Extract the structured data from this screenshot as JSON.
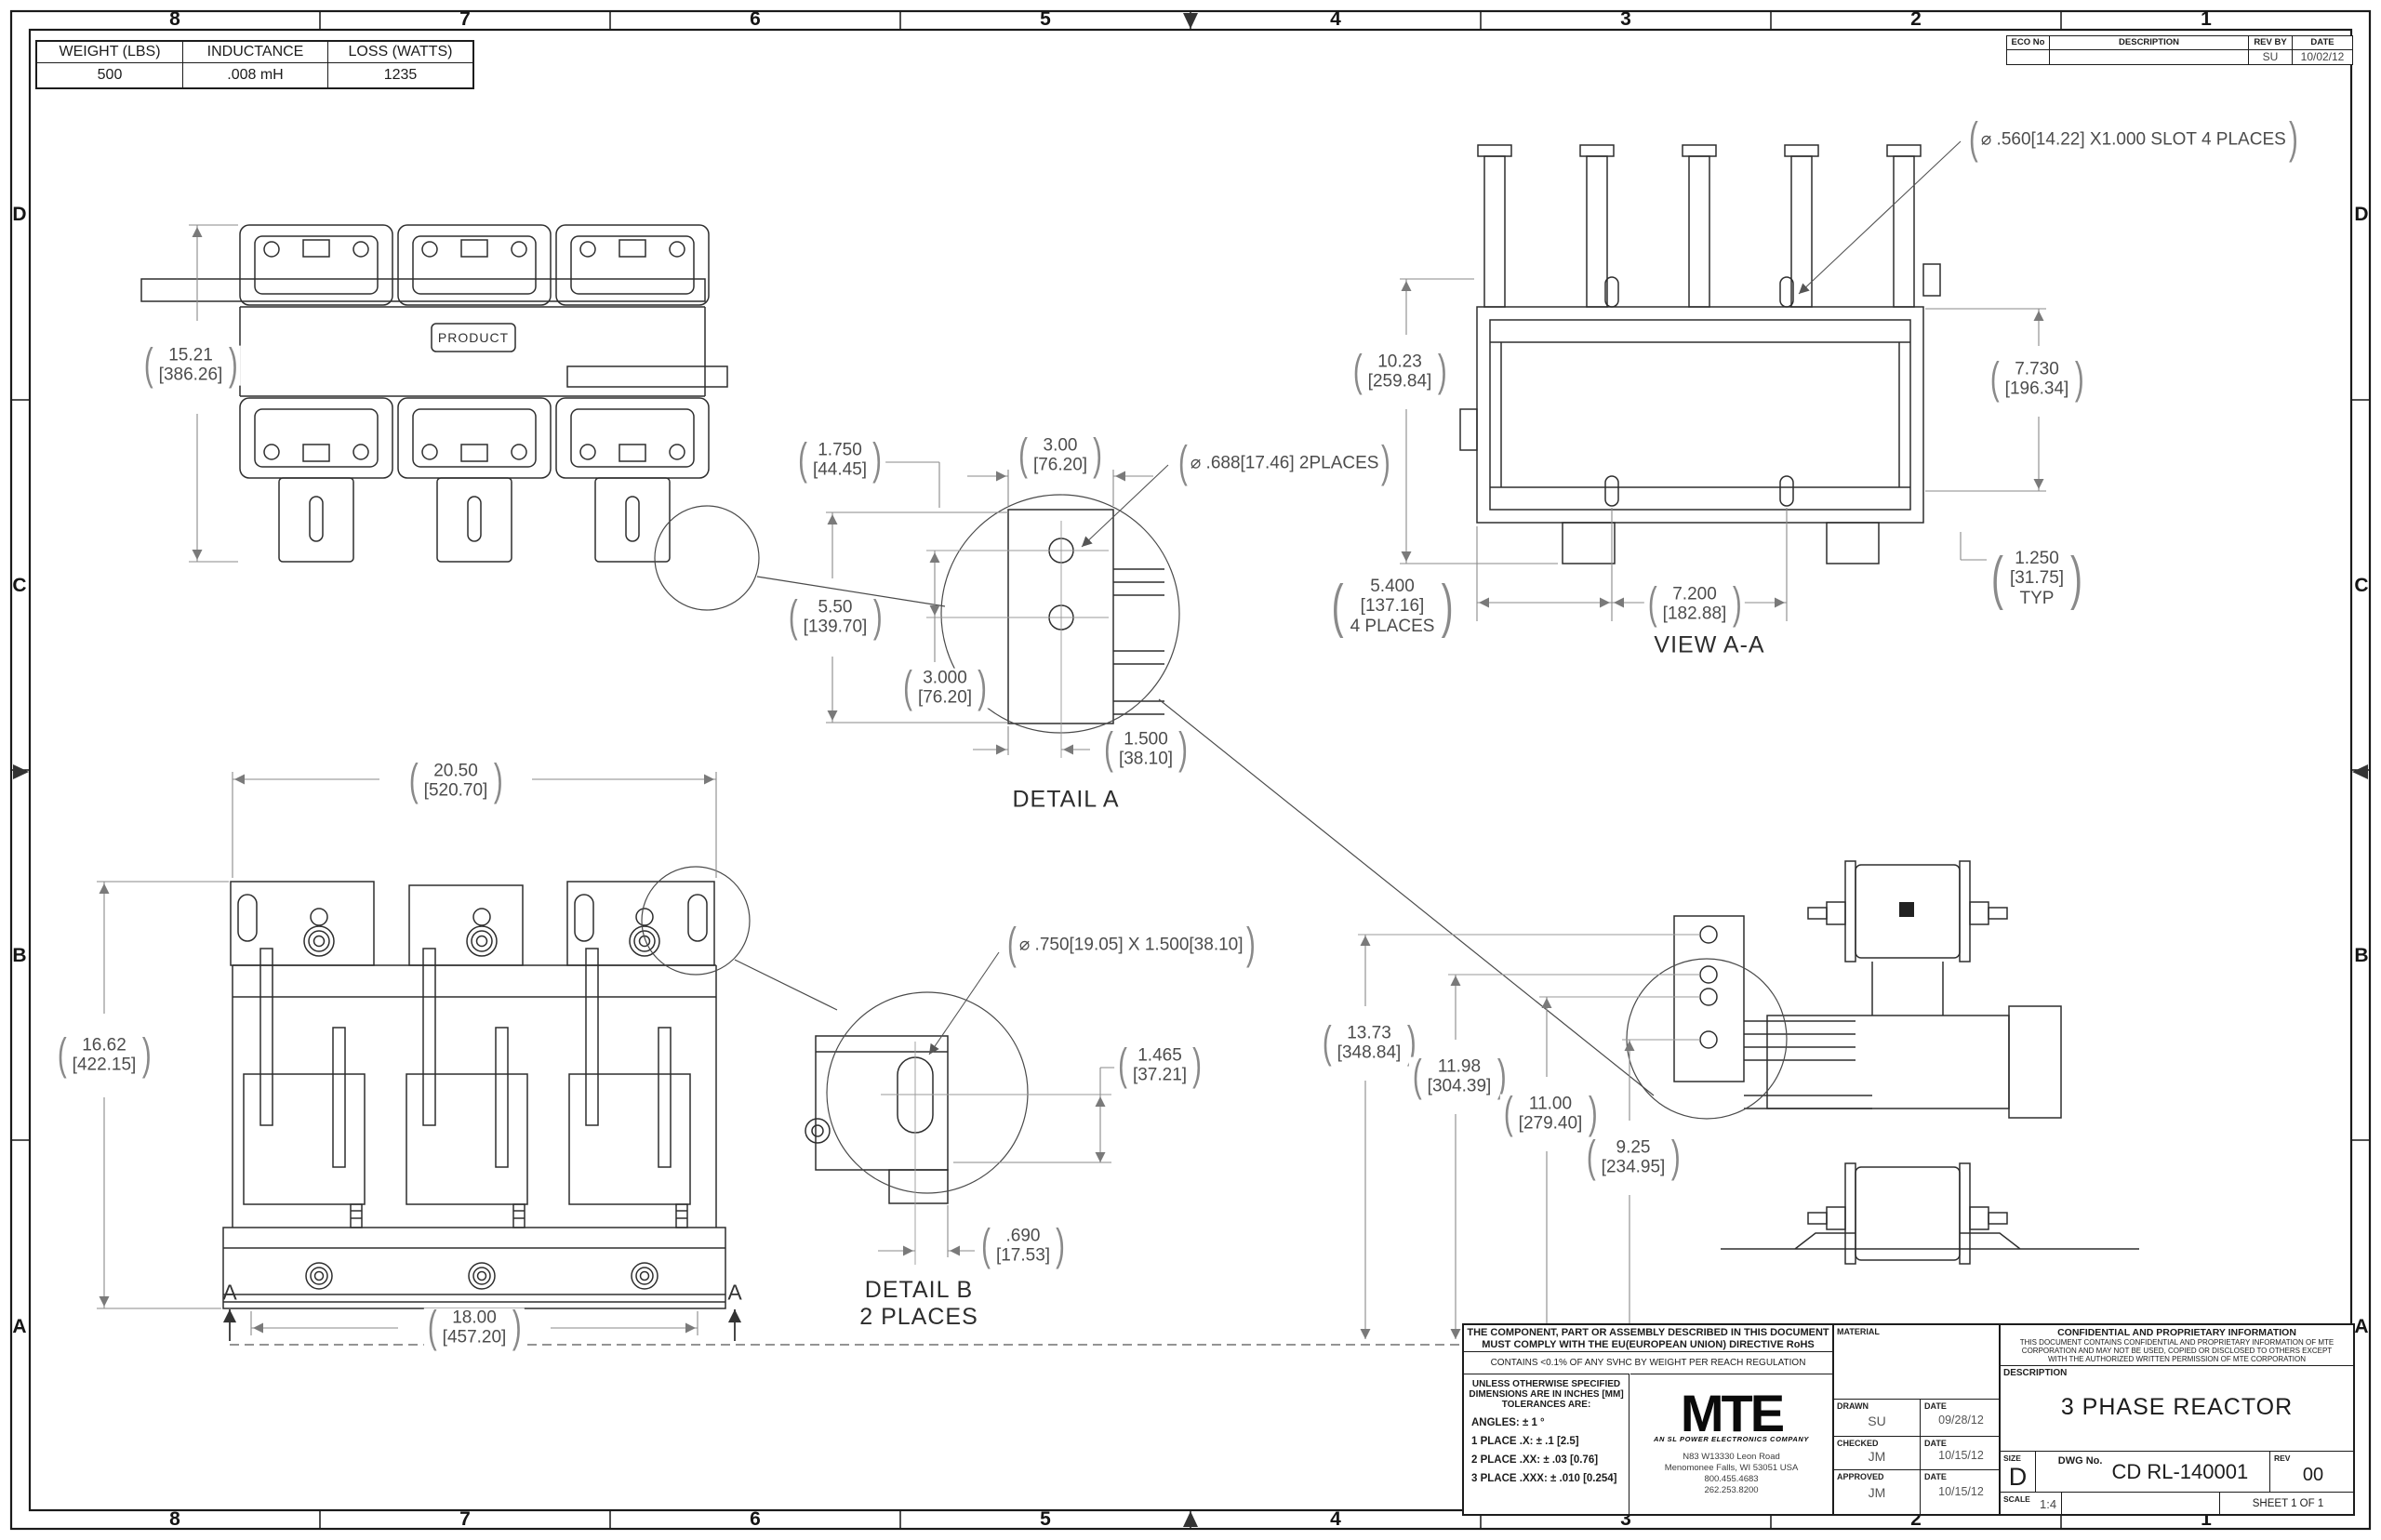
{
  "punct": {
    "lp": "(",
    "rp": ")"
  },
  "zones": {
    "cols": [
      "8",
      "7",
      "6",
      "5",
      "4",
      "3",
      "2",
      "1"
    ],
    "rows": [
      "D",
      "C",
      "B",
      "A"
    ]
  },
  "spec_table": {
    "headers": [
      "WEIGHT (LBS)",
      "INDUCTANCE",
      "LOSS (WATTS)"
    ],
    "values": [
      "500",
      ".008 mH",
      "1235"
    ]
  },
  "eco_table": {
    "headers": [
      "ECO No",
      "DESCRIPTION",
      "REV BY",
      "DATE"
    ],
    "row": {
      "eco_no": "",
      "description": "",
      "rev_by": "SU",
      "date": "10/02/12"
    }
  },
  "views": {
    "top": {
      "product": "PRODUCT",
      "height": {
        "in": "15.21",
        "mm": "[386.26]"
      }
    },
    "aa": {
      "label": "VIEW A-A",
      "slot_callout": "⌀ .560[14.22] X1.000 SLOT 4 PLACES",
      "height": {
        "in": "10.23",
        "mm": "[259.84]"
      },
      "width": {
        "in": "7.730",
        "mm": "[196.34]"
      },
      "spacing": {
        "in": "5.400",
        "mm": "[137.16]",
        "note": "4 PLACES"
      },
      "pitch": {
        "in": "7.200",
        "mm": "[182.88]"
      },
      "edge": {
        "in": "1.250",
        "mm": "[31.75]",
        "note": "TYP"
      }
    },
    "detail_a": {
      "label": "DETAIL A",
      "hole_callout": "⌀ .688[17.46]  2PLACES",
      "width_top": {
        "in": "3.00",
        "mm": "[76.20]"
      },
      "offset_top": {
        "in": "1.750",
        "mm": "[44.45]"
      },
      "height": {
        "in": "5.50",
        "mm": "[139.70]"
      },
      "pitch": {
        "in": "3.000",
        "mm": "[76.20]"
      },
      "offset_bottom": {
        "in": "1.500",
        "mm": "[38.10]"
      }
    },
    "detail_b": {
      "label": "DETAIL B",
      "note": "2 PLACES",
      "slot_callout": "⌀ .750[19.05]  X 1.500[38.10]",
      "height": {
        "in": "1.465",
        "mm": "[37.21]"
      },
      "width": {
        "in": ".690",
        "mm": "[17.53]"
      }
    },
    "front": {
      "section_letter": "A",
      "width": {
        "in": "20.50",
        "mm": "[520.70]"
      },
      "height": {
        "in": "16.62",
        "mm": "[422.15]"
      },
      "mounting": {
        "in": "18.00",
        "mm": "[457.20]"
      }
    },
    "side": {
      "h1": {
        "in": "13.73",
        "mm": "[348.84]"
      },
      "h2": {
        "in": "11.98",
        "mm": "[304.39]"
      },
      "h3": {
        "in": "11.00",
        "mm": "[279.40]"
      },
      "h4": {
        "in": "9.25",
        "mm": "[234.95]"
      }
    }
  },
  "title_block": {
    "compliance_line1": "THE COMPONENT, PART OR ASSEMBLY DESCRIBED IN THIS DOCUMENT",
    "compliance_line2": "MUST COMPLY WITH THE EU(EUROPEAN UNION) DIRECTIVE RoHS",
    "reach": "CONTAINS <0.1% OF ANY SVHC BY WEIGHT PER REACH REGULATION",
    "tolerance_header1": "UNLESS OTHERWISE SPECIFIED",
    "tolerance_header2": "DIMENSIONS ARE IN INCHES [MM]",
    "tolerance_header3": "TOLERANCES ARE:",
    "tol_angles": "ANGLES: ± 1 °",
    "tol_1": "1 PLACE .X: ± .1 [2.5]",
    "tol_2": "2 PLACE .XX: ± .03 [0.76]",
    "tol_3": "3 PLACE .XXX: ± .010 [0.254]",
    "logo_text": "MTE",
    "logo_tagline": "AN SL POWER ELECTRONICS COMPANY",
    "address_line1": "N83 W13330 Leon Road",
    "address_line2": "Menomonee Falls, WI 53051 USA",
    "address_line3": "800.455.4683",
    "address_line4": "262.253.8200",
    "material_label": "MATERIAL",
    "drawn_label": "DRAWN",
    "drawn_by": "SU",
    "drawn_date_label": "DATE",
    "drawn_date": "09/28/12",
    "checked_label": "CHECKED",
    "checked_by": "JM",
    "checked_date_label": "DATE",
    "checked_date": "10/15/12",
    "approved_label": "APPROVED",
    "approved_by": "JM",
    "approved_date_label": "DATE",
    "approved_date": "10/15/12",
    "confidential_title": "CONFIDENTIAL AND PROPRIETARY INFORMATION",
    "confidential_line1": "THIS DOCUMENT CONTAINS CONFIDENTIAL AND PROPRIETARY INFORMATION OF MTE",
    "confidential_line2": "CORPORATION AND MAY NOT BE USED, COPIED OR DISCLOSED TO OTHERS EXCEPT",
    "confidential_line3": "WITH THE AUTHORIZED WRITTEN PERMISSION OF MTE CORPORATION",
    "description_label": "DESCRIPTION",
    "description": "3 PHASE REACTOR",
    "size_label": "SIZE",
    "size": "D",
    "dwg_label": "DWG No.",
    "dwg_no": "CD RL-140001",
    "rev_label": "REV",
    "rev": "00",
    "scale_label": "SCALE",
    "scale": "1:4",
    "sheet": "SHEET 1  OF 1"
  }
}
